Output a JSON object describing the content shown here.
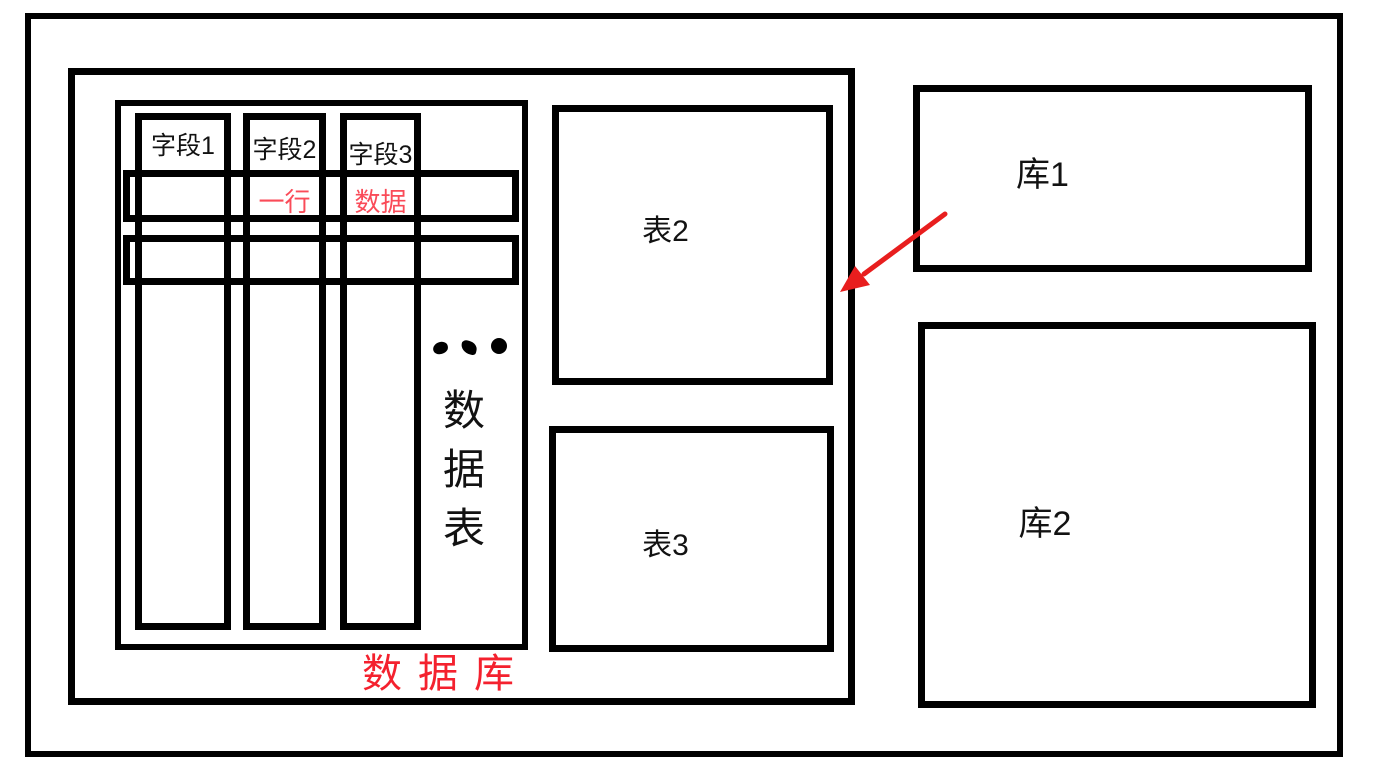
{
  "diagram": {
    "database": {
      "label": "数据库",
      "table": {
        "columns": [
          {
            "label": "字段1"
          },
          {
            "label": "字段2"
          },
          {
            "label": "字段3"
          }
        ],
        "row_labels": {
          "col2": "一行",
          "col3": "数据"
        },
        "vertical_label": [
          "数",
          "据",
          "表"
        ]
      },
      "table2": {
        "label": "表2"
      },
      "table3": {
        "label": "表3"
      }
    },
    "db1": {
      "label": "库1"
    },
    "db2": {
      "label": "库2"
    }
  },
  "icons": {
    "ellipsis": "ellipsis-dots",
    "arrow": "red-arrow"
  },
  "colors": {
    "stroke": "#000000",
    "row_annotation_red": "#fa4b58",
    "database_label_red": "#f4212e",
    "arrow_red": "#e81e1e"
  }
}
